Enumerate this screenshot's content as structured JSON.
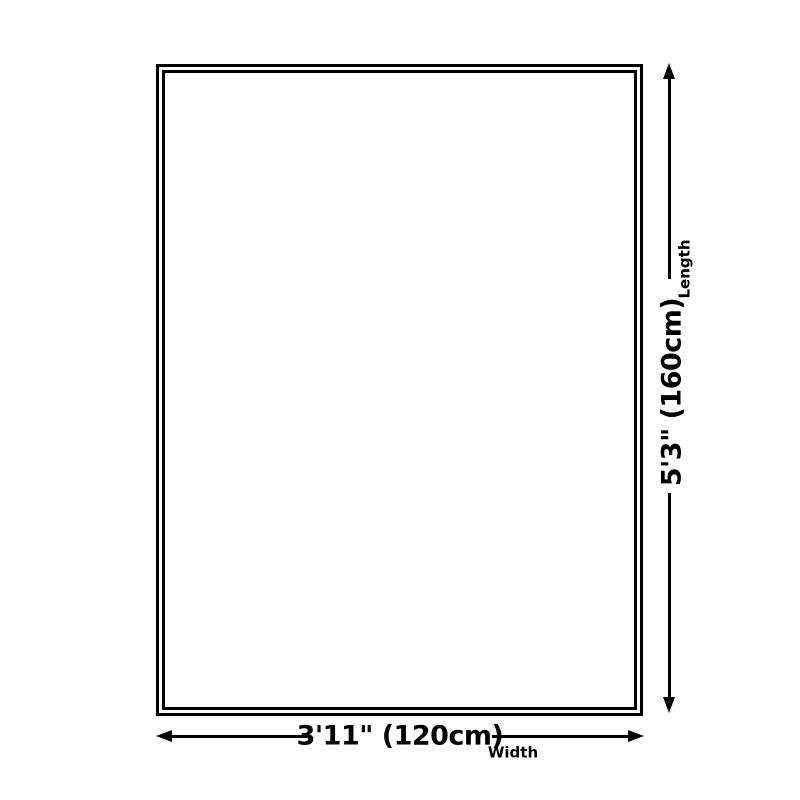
{
  "diagram": {
    "colors": {
      "background": "#ffffff",
      "line": "#000000",
      "text": "#000000"
    },
    "length": {
      "value": "5'3\" (160cm)",
      "label": "Length"
    },
    "width": {
      "value": "3'11\" (120cm)",
      "label": "Width"
    }
  }
}
